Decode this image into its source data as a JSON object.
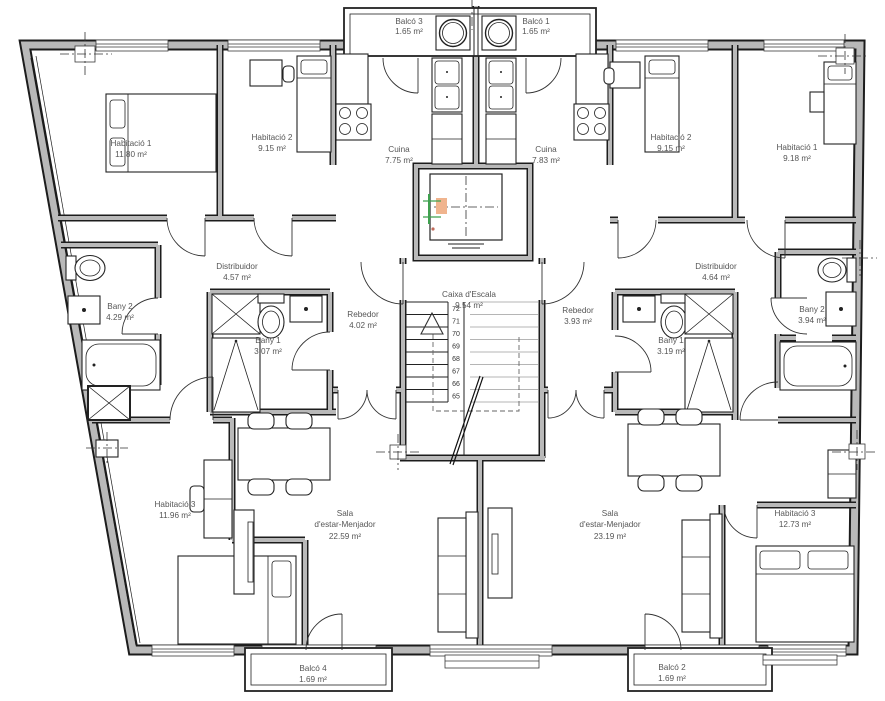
{
  "plan": {
    "labels": {
      "balco3": {
        "name": "Balcó 3",
        "area": "1.65 m²"
      },
      "balco1": {
        "name": "Balcó 1",
        "area": "1.65 m²"
      },
      "hab1_left": {
        "name": "Habitació 1",
        "area": "11.80 m²"
      },
      "hab2_left": {
        "name": "Habitació 2",
        "area": "9.15 m²"
      },
      "cuina_left": {
        "name": "Cuina",
        "area": "7.75 m²"
      },
      "cuina_right": {
        "name": "Cuina",
        "area": "7.83 m²"
      },
      "hab2_right": {
        "name": "Habitació 2",
        "area": "9.15 m²"
      },
      "hab1_right": {
        "name": "Habitació 1",
        "area": "9.18 m²"
      },
      "distribuidor_left": {
        "name": "Distribuidor",
        "area": "4.57 m²"
      },
      "bany2_left": {
        "name": "Bany 2",
        "area": "4.29 m²"
      },
      "bany1_left": {
        "name": "Bany 1",
        "area": "3.07 m²"
      },
      "rebedor_left": {
        "name": "Rebedor",
        "area": "4.02 m²"
      },
      "caixa_escala": {
        "name": "Caixa d'Escala",
        "area": "9.54 m²"
      },
      "rebedor_right": {
        "name": "Rebedor",
        "area": "3.93 m²"
      },
      "bany1_right": {
        "name": "Bany 1",
        "area": "3.19 m²"
      },
      "distribuidor_right": {
        "name": "Distribuidor",
        "area": "4.64 m²"
      },
      "bany2_right": {
        "name": "Bany 2",
        "area": "3.94 m²"
      },
      "hab3_left": {
        "name": "Habitació 3",
        "area": "11.96 m²"
      },
      "sala_left": {
        "name_line1": "Sala",
        "name_line2": "d'estar-Menjador",
        "area": "22.59 m²"
      },
      "sala_right": {
        "name_line1": "Sala",
        "name_line2": "d'estar-Menjador",
        "area": "23.19 m²"
      },
      "hab3_right": {
        "name": "Habitació 3",
        "area": "12.73 m²"
      },
      "balco4": {
        "name": "Balcó 4",
        "area": "1.69 m²"
      },
      "balco2": {
        "name": "Balcó 2",
        "area": "1.69 m²"
      }
    },
    "stairs": {
      "steps": [
        "72",
        "71",
        "70",
        "69",
        "68",
        "67",
        "66",
        "65"
      ]
    },
    "colors": {
      "wall_fill": "#b9b9b9",
      "line": "#1c1c1c",
      "label": "#555555",
      "light_step": "#b5b5b5",
      "marker_green": "#3fa14f",
      "marker_orange": "#f0b48e"
    }
  }
}
